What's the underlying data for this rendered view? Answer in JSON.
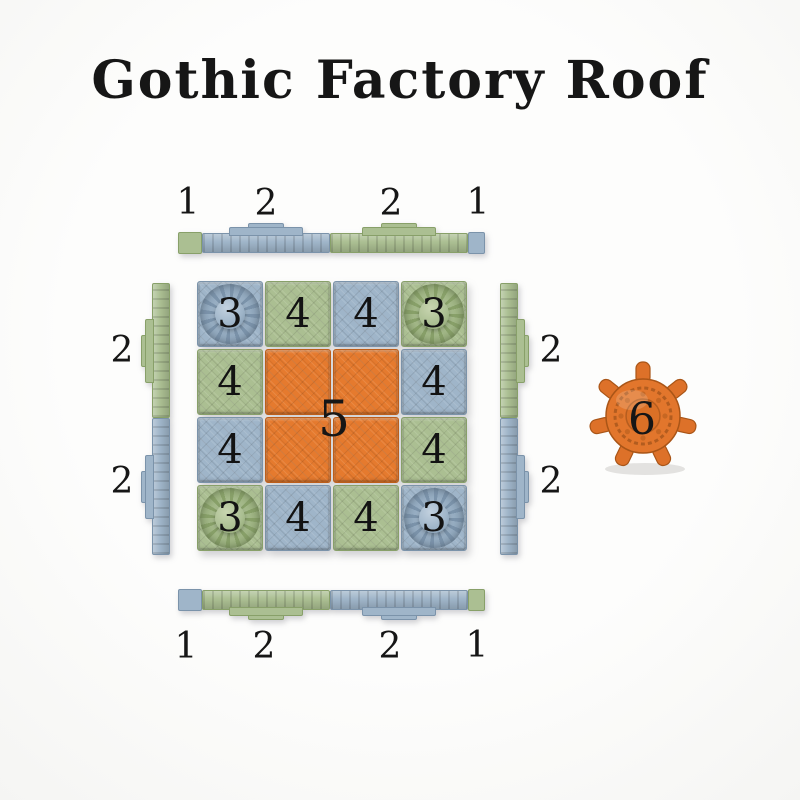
{
  "title": "Gothic Factory Roof",
  "palette": {
    "background": "#fcfcfb",
    "blue": "#9fb5c9",
    "green": "#abbf92",
    "orange": "#e57a2e",
    "number_color": "#161616"
  },
  "edges": {
    "top": {
      "labels": [
        "1",
        "2",
        "2",
        "1"
      ],
      "segments": [
        {
          "piece": "1",
          "color": "green"
        },
        {
          "piece": "2",
          "color": "blue"
        },
        {
          "piece": "2",
          "color": "green"
        },
        {
          "piece": "1",
          "color": "blue"
        }
      ]
    },
    "left": {
      "labels": [
        "2",
        "2"
      ],
      "segments": [
        {
          "piece": "2",
          "color": "green"
        },
        {
          "piece": "2",
          "color": "blue"
        }
      ]
    },
    "right": {
      "labels": [
        "2",
        "2"
      ],
      "segments": [
        {
          "piece": "2",
          "color": "green"
        },
        {
          "piece": "2",
          "color": "blue"
        }
      ]
    },
    "bottom": {
      "labels": [
        "1",
        "2",
        "2",
        "1"
      ],
      "segments": [
        {
          "piece": "1",
          "color": "blue"
        },
        {
          "piece": "2",
          "color": "green"
        },
        {
          "piece": "2",
          "color": "blue"
        },
        {
          "piece": "1",
          "color": "green"
        }
      ]
    }
  },
  "grid": {
    "center_label": "5",
    "rows": [
      {
        "cells": [
          {
            "label": "3",
            "color": "blue",
            "type": "dome"
          },
          {
            "label": "4",
            "color": "green",
            "type": "flat"
          },
          {
            "label": "4",
            "color": "blue",
            "type": "flat"
          },
          {
            "label": "3",
            "color": "green",
            "type": "dome"
          }
        ]
      },
      {
        "cells": [
          {
            "label": "4",
            "color": "green",
            "type": "flat"
          },
          {
            "label": "",
            "color": "orange",
            "type": "flat"
          },
          {
            "label": "",
            "color": "orange",
            "type": "flat"
          },
          {
            "label": "4",
            "color": "blue",
            "type": "flat"
          }
        ]
      },
      {
        "cells": [
          {
            "label": "4",
            "color": "blue",
            "type": "flat"
          },
          {
            "label": "",
            "color": "orange",
            "type": "flat"
          },
          {
            "label": "",
            "color": "orange",
            "type": "flat"
          },
          {
            "label": "4",
            "color": "green",
            "type": "flat"
          }
        ]
      },
      {
        "cells": [
          {
            "label": "3",
            "color": "green",
            "type": "dome"
          },
          {
            "label": "4",
            "color": "blue",
            "type": "flat"
          },
          {
            "label": "4",
            "color": "green",
            "type": "flat"
          },
          {
            "label": "3",
            "color": "blue",
            "type": "dome"
          }
        ]
      }
    ]
  },
  "wheel": {
    "label": "6",
    "color": "orange"
  }
}
